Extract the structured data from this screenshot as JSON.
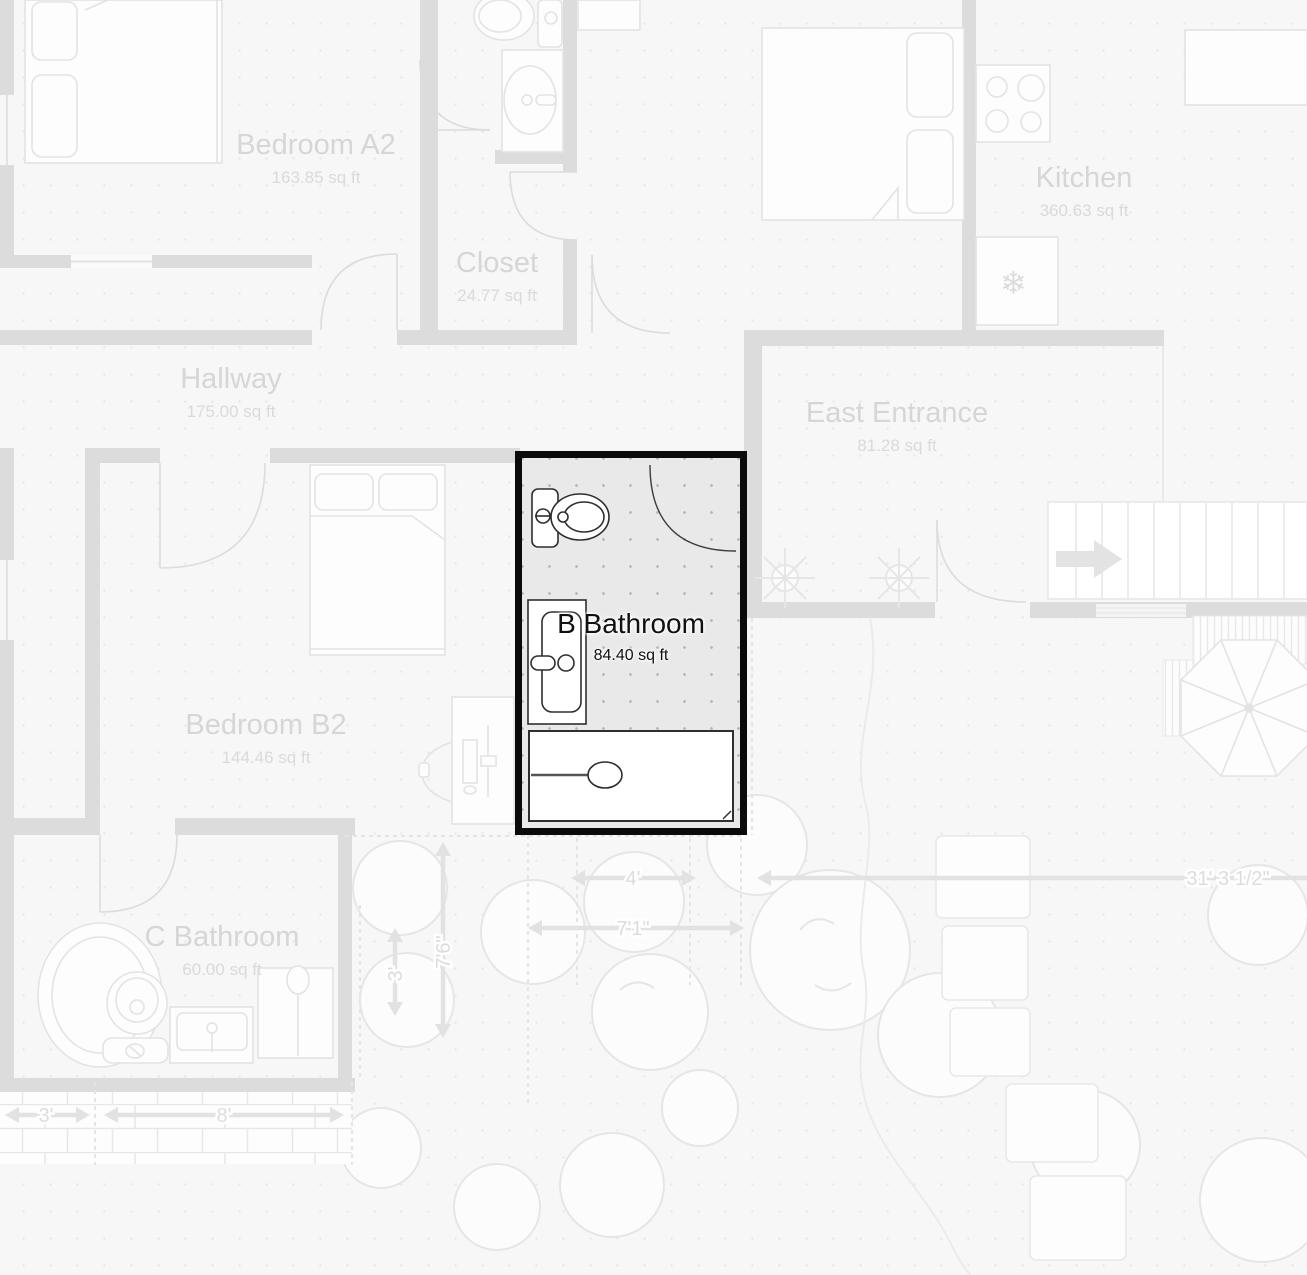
{
  "colors": {
    "background": "#f7f7f7",
    "wall": "#dcdcdc",
    "faint_line": "#e3e3e3",
    "faint_text": "#d6d6d6",
    "selected_outline": "#0a0a0a",
    "selected_fill": "#e9e9e9"
  },
  "selected_room": {
    "name": "B Bathroom",
    "area": "84.40 sq ft"
  },
  "rooms": [
    {
      "name": "Bedroom A2",
      "area": "163.85 sq ft"
    },
    {
      "name": "Closet",
      "area": "24.77 sq ft"
    },
    {
      "name": "Hallway",
      "area": "175.00 sq ft"
    },
    {
      "name": "Kitchen",
      "area": "360.63 sq ft"
    },
    {
      "name": "East Entrance",
      "area": "81.28 sq ft"
    },
    {
      "name": "Bedroom B2",
      "area": "144.46 sq ft"
    },
    {
      "name": "C Bathroom",
      "area": "60.00 sq ft"
    }
  ],
  "dimensions": [
    {
      "text": "4'"
    },
    {
      "text": "7'1\""
    },
    {
      "text": "3'"
    },
    {
      "text": "8'"
    },
    {
      "text": "31' 3 1/2\""
    },
    {
      "text": "7'6\""
    },
    {
      "text": "3'"
    }
  ],
  "icons": {
    "fridge_snowflake": "❄"
  }
}
